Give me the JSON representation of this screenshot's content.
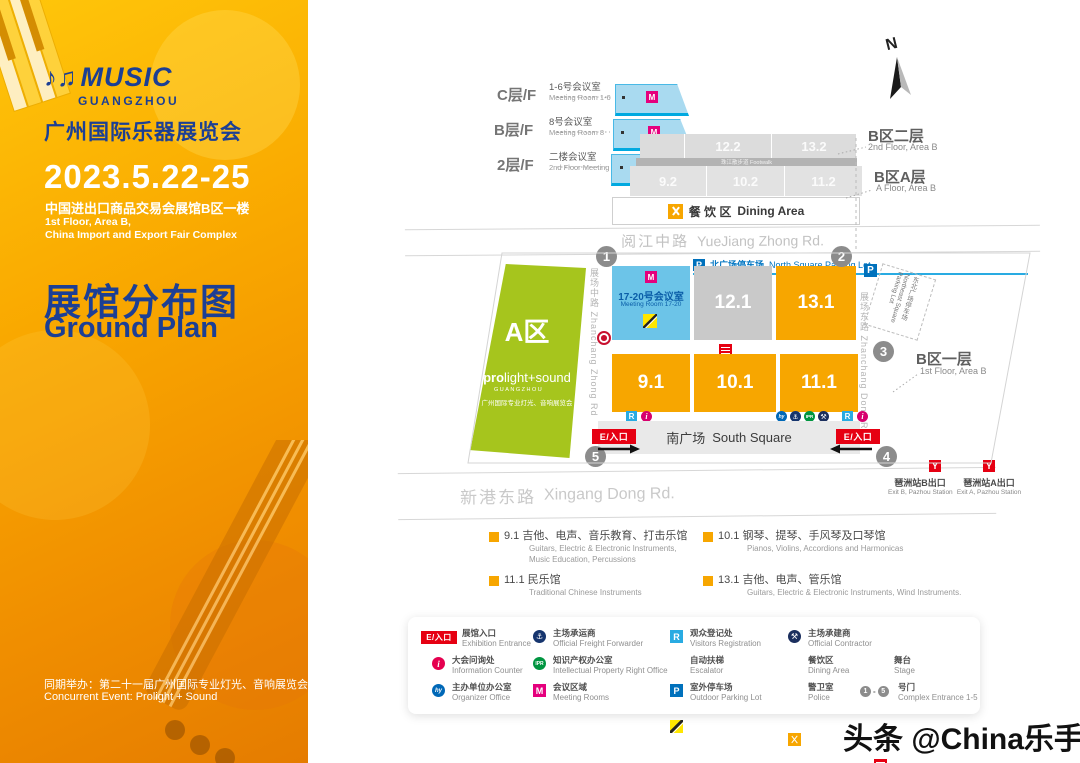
{
  "sidebar": {
    "logo": {
      "music": "MUSIC",
      "city": "GUANGZHOU",
      "title_cn": "广州国际乐器展览会"
    },
    "dates": "2023.5.22-25",
    "venue_cn": "中国进出口商品交易会展馆B区一楼",
    "venue_en_line1": "1st Floor, Area B,",
    "venue_en_line2": "China Import and Export Fair Complex",
    "plan_title_cn": "展馆分布图",
    "plan_title_en": "Ground  Plan",
    "concurrent_cn": "同期举办：第二十一届广州国际专业灯光、音响展览会",
    "concurrent_en": "Concurrent Event: Prolight + Sound"
  },
  "icons": {
    "m": "M",
    "r": "R",
    "p": "P",
    "i": "i",
    "y": "Y",
    "hy": "hy",
    "ipr": "IPR",
    "freight": "⚓",
    "contractor": "⚒",
    "compass": "N",
    "notes": "♪♫"
  },
  "map": {
    "floor_levels": [
      {
        "level": "C层/F",
        "name_cn": "1-6号会议室",
        "name_en": "Meeting Room 1-6"
      },
      {
        "level": "B层/F",
        "name_cn": "8号会议室",
        "name_en": "Meeting Room 8"
      },
      {
        "level": "2层/F",
        "name_cn": "二楼会议室",
        "name_en": "2nd Floor Meeting Room"
      }
    ],
    "area_b_2f": {
      "cn": "B区二层",
      "en": "2nd Floor, Area B"
    },
    "area_b_af": {
      "cn": "B区A层",
      "en": "A Floor, Area B"
    },
    "area_b_1f": {
      "cn": "B区一层",
      "en": "1st Floor, Area B"
    },
    "halls_2f": [
      "12.2",
      "13.2"
    ],
    "footwalk": "珠江散步道 Footwalk",
    "halls_af": [
      "9.2",
      "10.2",
      "11.2"
    ],
    "dining": {
      "cn": "餐 饮 区",
      "en": "Dining Area"
    },
    "roads": {
      "top": {
        "cn": "阅江中路",
        "en": "YueJiang Zhong Rd."
      },
      "bottom": {
        "cn": "新港东路",
        "en": "Xingang Dong Rd."
      },
      "left": "展场中路 Zhanchang Zhong Rd",
      "right": "展场东路 Zhanchang Dong Rd"
    },
    "parking_north": {
      "cn": "北广场停车场",
      "en": "North Square Parking Lot"
    },
    "parking_northeast": "东北广场停车场 Northeast Square Parking Lot",
    "hall_a": {
      "name": "A区",
      "brand_bold": "pro",
      "brand_light": "light+sound",
      "city": "GUANGZHOU",
      "desc_cn": "广州国际专业灯光、音响展览会"
    },
    "meeting_hall": {
      "cn": "17-20号会议室",
      "en": "Meeting Room 17-20"
    },
    "halls_1f_row1": [
      "12.1",
      "13.1"
    ],
    "halls_1f_row2": [
      "9.1",
      "10.1",
      "11.1"
    ],
    "south_square": {
      "cn": "南广场",
      "en": "South Square"
    },
    "entrance_badge": "E/入口",
    "gate_numbers": [
      "1",
      "2",
      "3",
      "4",
      "5"
    ],
    "metro_exit_b": {
      "cn": "琶洲站B出口",
      "en": "Exit B, Pazhou Station"
    },
    "metro_exit_a": {
      "cn": "琶洲站A出口",
      "en": "Exit A, Pazhou Station"
    }
  },
  "hall_legend": [
    {
      "num": "9.1",
      "cn": "吉他、电声、音乐教育、打击乐馆",
      "en1": "Guitars, Electric & Electronic Instruments,",
      "en2": "Music Education, Percussions"
    },
    {
      "num": "10.1",
      "cn": "钢琴、提琴、手风琴及口琴馆",
      "en1": "Pianos, Violins, Accordions and Harmonicas",
      "en2": ""
    },
    {
      "num": "11.1",
      "cn": "民乐馆",
      "en1": "Traditional Chinese Instruments",
      "en2": ""
    },
    {
      "num": "13.1",
      "cn": "吉他、电声、管乐馆",
      "en1": "Guitars, Electric & Electronic Instruments, Wind Instruments.",
      "en2": ""
    }
  ],
  "icon_legend": {
    "entrance": {
      "cn": "展馆入口",
      "en": "Exhibition Entrance"
    },
    "info": {
      "cn": "大会问询处",
      "en": "Information Counter"
    },
    "organizer": {
      "cn": "主办单位办公室",
      "en": "Organizer Office"
    },
    "freight": {
      "cn": "主场承运商",
      "en": "Official Freight Forwarder"
    },
    "ipr": {
      "cn": "知识产权办公室",
      "en": "Intellectual Property Right Office"
    },
    "meeting": {
      "cn": "会议区域",
      "en": "Meeting Rooms"
    },
    "registration": {
      "cn": "观众登记处",
      "en": "Visitors Registration"
    },
    "escalator": {
      "cn": "自动扶梯",
      "en": "Escalator"
    },
    "parking": {
      "cn": "室外停车场",
      "en": "Outdoor Parking Lot"
    },
    "contractor": {
      "cn": "主场承建商",
      "en": "Official Contractor"
    },
    "dining": {
      "cn": "餐饮区",
      "en": "Dining Area"
    },
    "police": {
      "cn": "警卫室",
      "en": "Police"
    },
    "stage": {
      "cn": "舞台",
      "en": "Stage"
    },
    "gates": {
      "cn": "号门",
      "en": "Complex Entrance 1-5",
      "sep": "-"
    }
  },
  "watermark": "头条 @China乐手"
}
